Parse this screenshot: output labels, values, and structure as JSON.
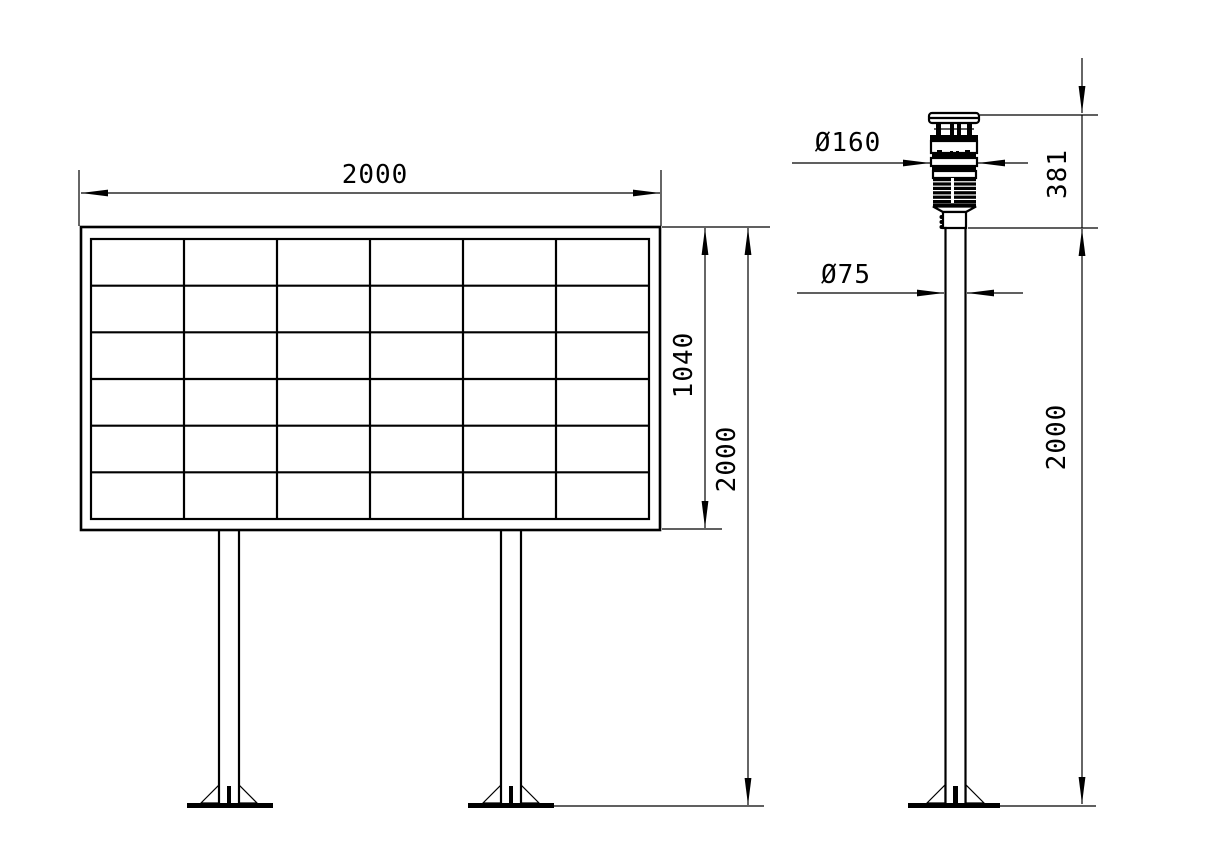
{
  "page": {
    "background": "#ffffff",
    "line_color": "#000000",
    "description": "technical drawing - display board front view and sensor pole side view"
  },
  "front_view": {
    "name": "display-board-front-view",
    "panel_grid": {
      "rows": 6,
      "cols": 6
    },
    "dim_width": "2000",
    "dim_panel_height": "1040",
    "dim_total_height": "2000"
  },
  "side_view": {
    "name": "sensor-pole-side-view",
    "dim_sensor_diameter": "Ø160",
    "dim_pole_diameter": "Ø75",
    "dim_sensor_height": "381",
    "dim_pole_height": "2000"
  }
}
